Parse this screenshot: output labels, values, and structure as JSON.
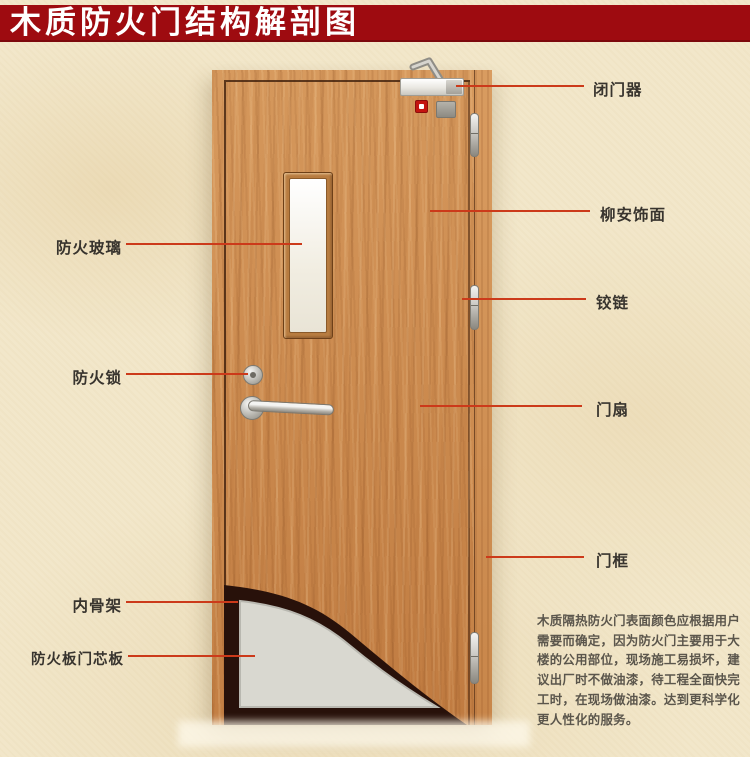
{
  "title": "木质防火门结构解剖图",
  "callouts_left": [
    {
      "label": "防火玻璃"
    },
    {
      "label": "防火锁"
    },
    {
      "label": "内骨架"
    },
    {
      "label": "防火板门芯板"
    }
  ],
  "callouts_right": [
    {
      "label": "闭门器"
    },
    {
      "label": "柳安饰面"
    },
    {
      "label": "铰链"
    },
    {
      "label": "门扇"
    },
    {
      "label": "门框"
    }
  ],
  "description_lines": [
    "木质隔热防火门表面颜色应根据用户",
    "需要而确定，因为防火门主要用于大",
    "楼的公用部位，现场施工易损坏，建",
    "议出厂时不做油漆，待工程全面快完",
    "工时，在现场做油漆。达到更科学化",
    "更人性化的服务。"
  ],
  "colors": {
    "banner": "#9e0b10",
    "banner_text": "#ffffff",
    "background": "#f2e7ca",
    "callout_line": "#cc3a1a",
    "label_text": "#38342e",
    "wood_frame": "#d79a5e",
    "wood_leaf": "#c98a50",
    "skeleton_dark": "#28110a",
    "core_gray": "#d9d8d0",
    "glass": "#faf8f0"
  }
}
